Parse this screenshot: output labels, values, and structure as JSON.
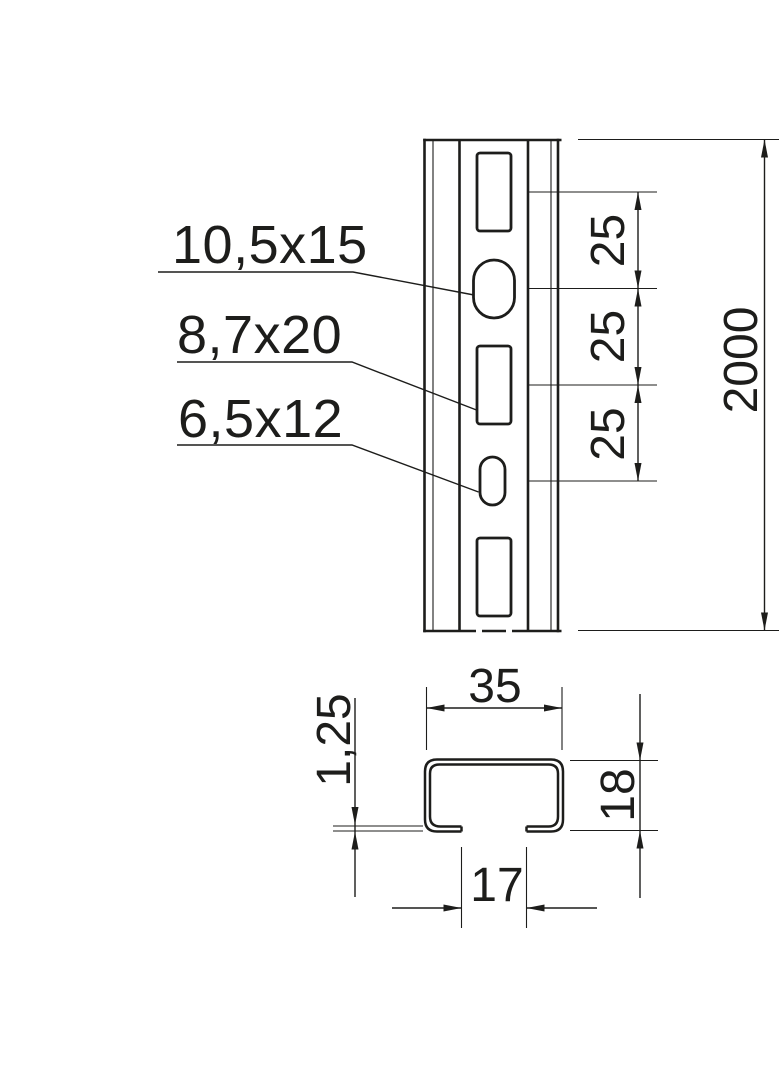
{
  "drawing": {
    "front_view": {
      "hole_labels": [
        {
          "label": "10,5x15",
          "points_to": "oval-hole"
        },
        {
          "label": "8,7x20",
          "points_to": "rect-slot"
        },
        {
          "label": "6,5x12",
          "points_to": "small-oval-hole"
        }
      ],
      "hole_spacing_dims": [
        {
          "label": "25"
        },
        {
          "label": "25"
        },
        {
          "label": "25"
        }
      ],
      "total_length_dim": {
        "label": "2000"
      }
    },
    "cross_section": {
      "outer_width_dim": {
        "label": "35"
      },
      "height_dim": {
        "label": "18"
      },
      "thickness_dim": {
        "label": "1,25"
      },
      "opening_width_dim": {
        "label": "17"
      }
    }
  },
  "colors": {
    "line": "#1d1d1b",
    "background": "#ffffff"
  }
}
